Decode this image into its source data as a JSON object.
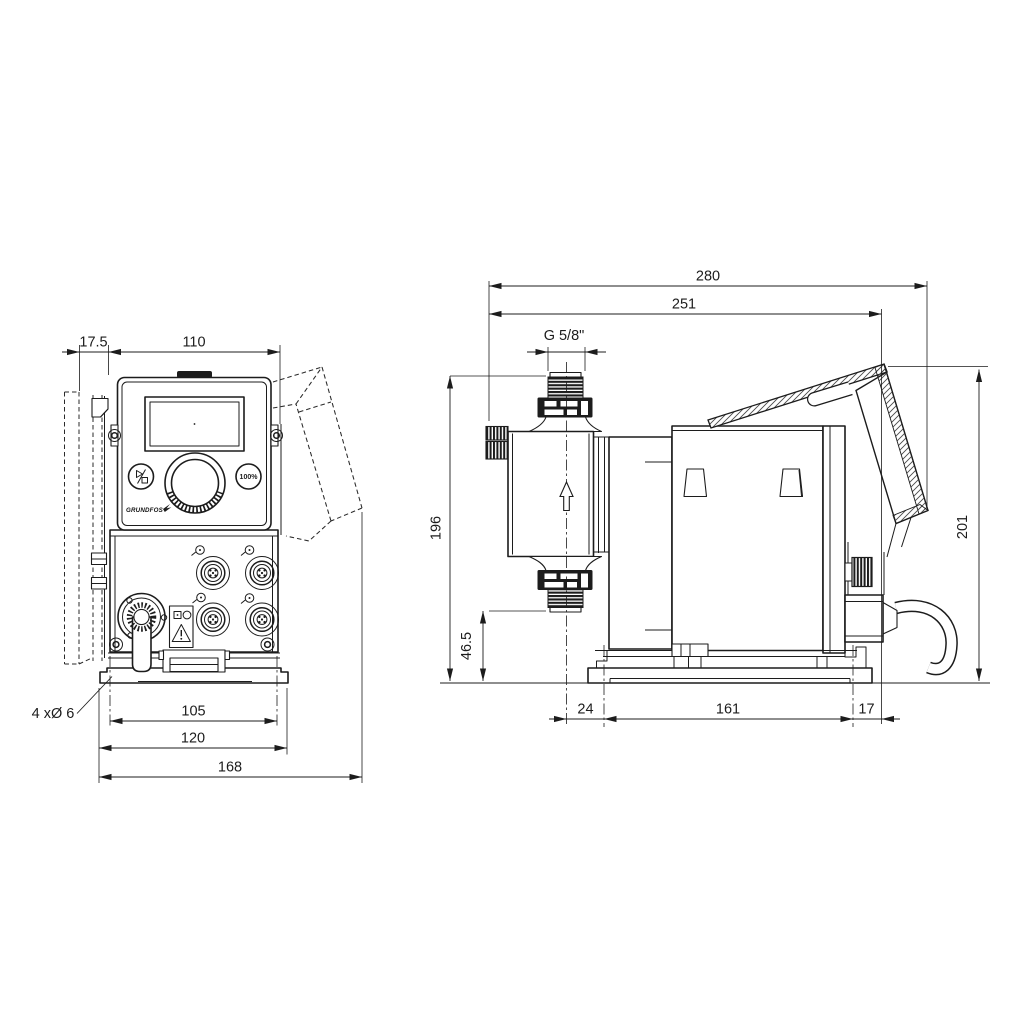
{
  "drawing": {
    "background": "#ffffff",
    "line_color": "#1c1c1c",
    "views": {
      "front": {
        "label": "front-view",
        "dimensions": {
          "wall_clearance": "17.5",
          "housing_width": "110",
          "mounting_hole_spacing": "105",
          "foot_width": "120",
          "overall_width_with_panel": "168"
        },
        "mounting_hole_note": "4 xØ 6",
        "control_panel": {
          "brand": "GRUNDFOS",
          "button_100_percent": "100%"
        }
      },
      "side": {
        "label": "side-view",
        "dimensions": {
          "overall_length": "280",
          "length_to_control_panel": "251",
          "connection_thread": "G 5/8\"",
          "height_to_connection": "196",
          "height_to_suction_valve": "46.5",
          "overall_height": "201",
          "foot_offset_front": "24",
          "foot_length": "161",
          "foot_offset_rear": "17"
        }
      }
    }
  }
}
